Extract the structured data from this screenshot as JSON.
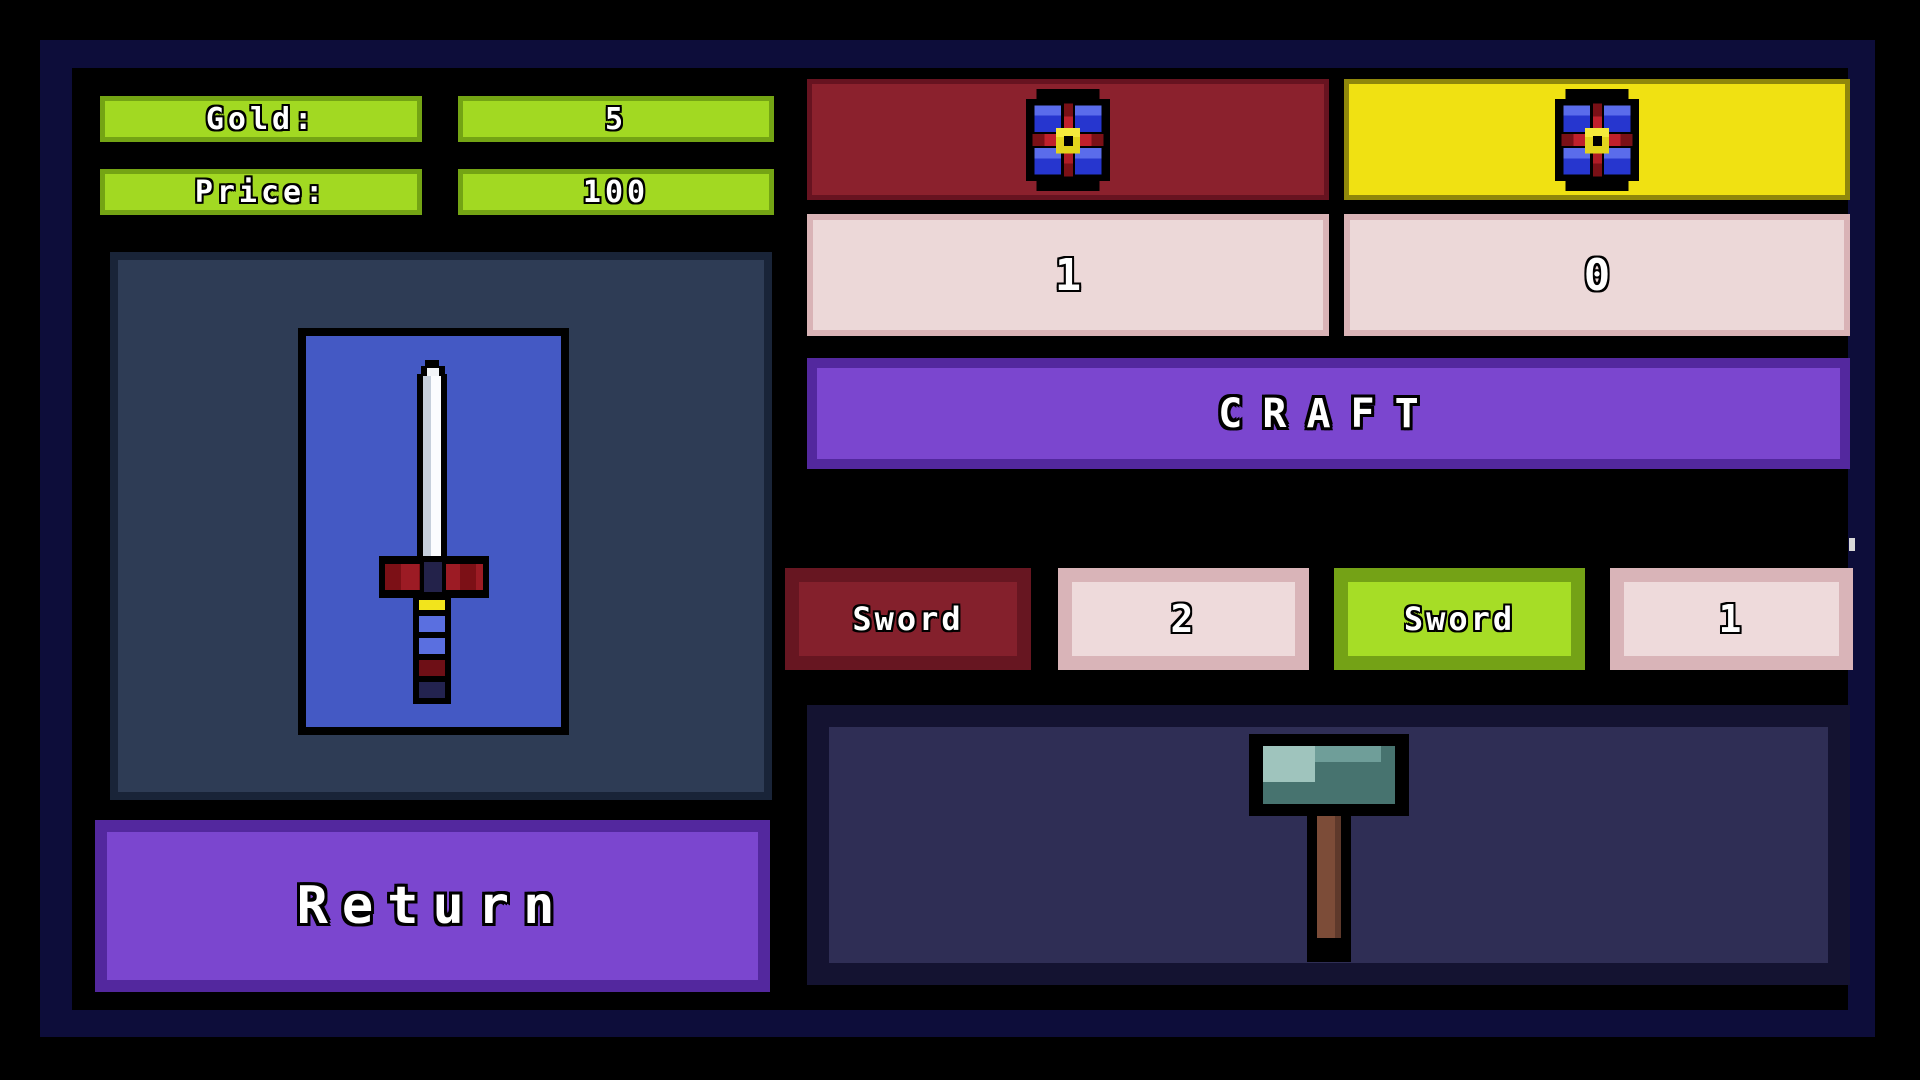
{
  "stats": {
    "gold_label": "Gold:",
    "gold_value": "5",
    "price_label": "Price:",
    "price_value": "100"
  },
  "preview": {
    "item_icon": "sword-icon"
  },
  "return_button": {
    "label": "Return"
  },
  "craft": {
    "button_label": "CRAFT",
    "ingredients": [
      {
        "slot": "red-panel",
        "icon": "flower-icon",
        "count": "1"
      },
      {
        "slot": "yellow-panel",
        "icon": "flower-icon",
        "count": "0"
      }
    ]
  },
  "recipes": [
    {
      "name": "Sword",
      "count": "2",
      "variant": "red"
    },
    {
      "name": "Sword",
      "count": "1",
      "variant": "green",
      "selected": true
    }
  ],
  "result": {
    "item_icon": "hammer-icon"
  },
  "colors": {
    "frame_navy": "#0d0d3a",
    "green_bright": "#a2d922",
    "green_border": "#74a414",
    "panel_slate": "#2e3c55",
    "card_blue": "#4459c4",
    "button_purple": "#7b46cf",
    "button_purple_border": "#53289e",
    "maroon": "#8b212d",
    "yellow": "#f0e112",
    "pink": "#ecd8d8",
    "result_navy": "#2f2e55"
  }
}
